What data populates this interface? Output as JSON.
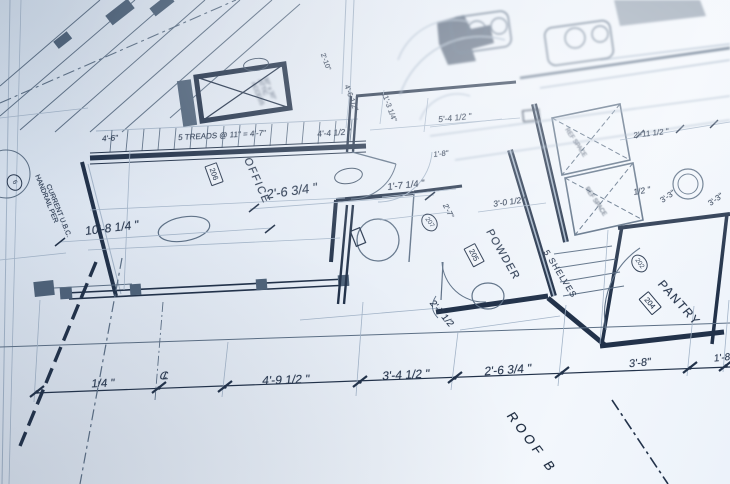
{
  "title": "Architectural floor plan blueprint photographed at an oblique angle",
  "stairs": {
    "treads_note": "5 TREADS @ 11\" = 4'-7\"",
    "dim_left": "4'-6\"",
    "dim_right": "4'-4 1/2 \""
  },
  "office": {
    "name": "OFFICE",
    "tag": "206",
    "width_dim": "10'-8 1/4 \"",
    "clearance_dim": "2'-6 3/4 \""
  },
  "hall": {
    "dim_small": "1'-7 1/4 \"",
    "dim_tiny": "1'-8\"",
    "door_tag": "207",
    "side_dim": "2'-7\"",
    "below_dim": "2'-7 1/2"
  },
  "powder": {
    "name": "POWDER",
    "tag": "205",
    "top_dim": "3'-0 1/2 \""
  },
  "pantry": {
    "name": "PANTRY",
    "tag": "204",
    "door_tag": "202",
    "shelves_note": "5 SHELVES"
  },
  "kitchen": {
    "ref_space_1": "REF SPACE",
    "ref_space_2": "REF SPACE"
  },
  "attic": {
    "note": "30\" x 30\" ATTIC ACCESS"
  },
  "handrail": {
    "line1": "HANDRAIL PER",
    "line2": "CURRENT U.B.C.",
    "detail_tag": "6"
  },
  "upper_dims": {
    "d1": "2'-10\"",
    "d2": "4'-6 1/2\"",
    "d3": "11'-3 1/4\"",
    "d4": "5'-4 1/2 \"",
    "d5": "2'-11 1/2 \"",
    "d6": "1/2 \"",
    "d7": "3'-3\"",
    "d8": "3'-3\""
  },
  "bottom_dims": {
    "d1": "1/4 \"",
    "centerline": "CL",
    "d2": "4'-9 1/2 \"",
    "d3": "3'-4 1/2 \"",
    "d4": "2'-6 3/4 \"",
    "d5": "3'-8\"",
    "d6": "1'-8"
  },
  "roof_note": "ROOF B",
  "colors": {
    "paper": "#e7edf6",
    "ink_dark": "#22324a",
    "ink_medium": "#5d7086",
    "ink_light": "#a3b4c8",
    "wall_fill": "#4f637a"
  }
}
